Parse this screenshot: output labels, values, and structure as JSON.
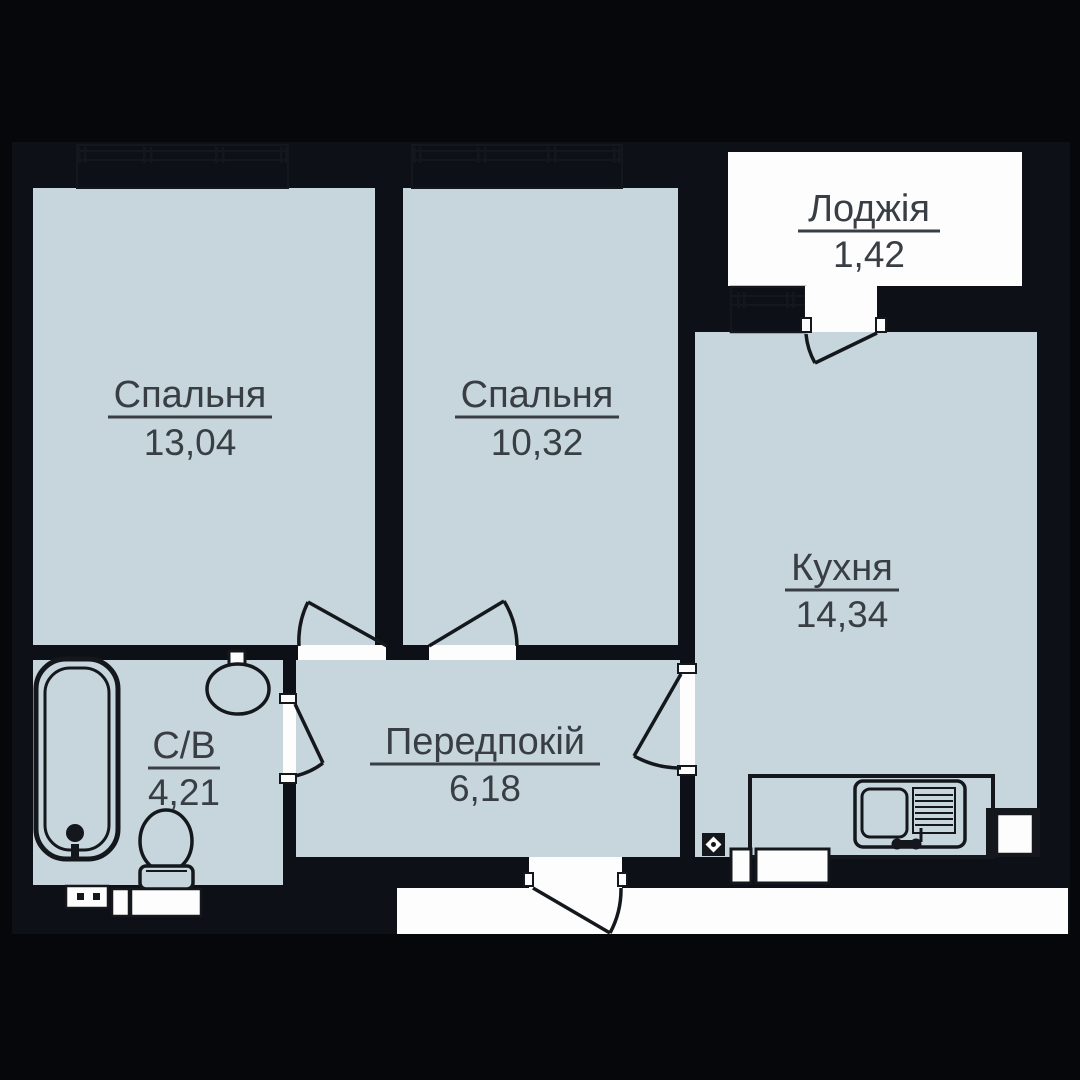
{
  "plan_title": "apartment-floor-plan",
  "colors": {
    "wall-color": "#0d1117",
    "bg-color": "#05070a",
    "floor-color": "#c7d6dd",
    "outside-color": "#fdfdfd",
    "line-color": "#14181c",
    "label-color": "#383e44"
  },
  "rooms": {
    "bedroom1": {
      "label": "Спальня",
      "area": "13,04"
    },
    "bedroom2": {
      "label": "Спальня",
      "area": "10,32"
    },
    "loggia": {
      "label": "Лоджія",
      "area": "1,42"
    },
    "kitchen": {
      "label": "Кухня",
      "area": "14,34"
    },
    "hallway": {
      "label": "Передпокій",
      "area": "6,18"
    },
    "bathroom": {
      "label": "С/В",
      "area": "4,21"
    }
  }
}
